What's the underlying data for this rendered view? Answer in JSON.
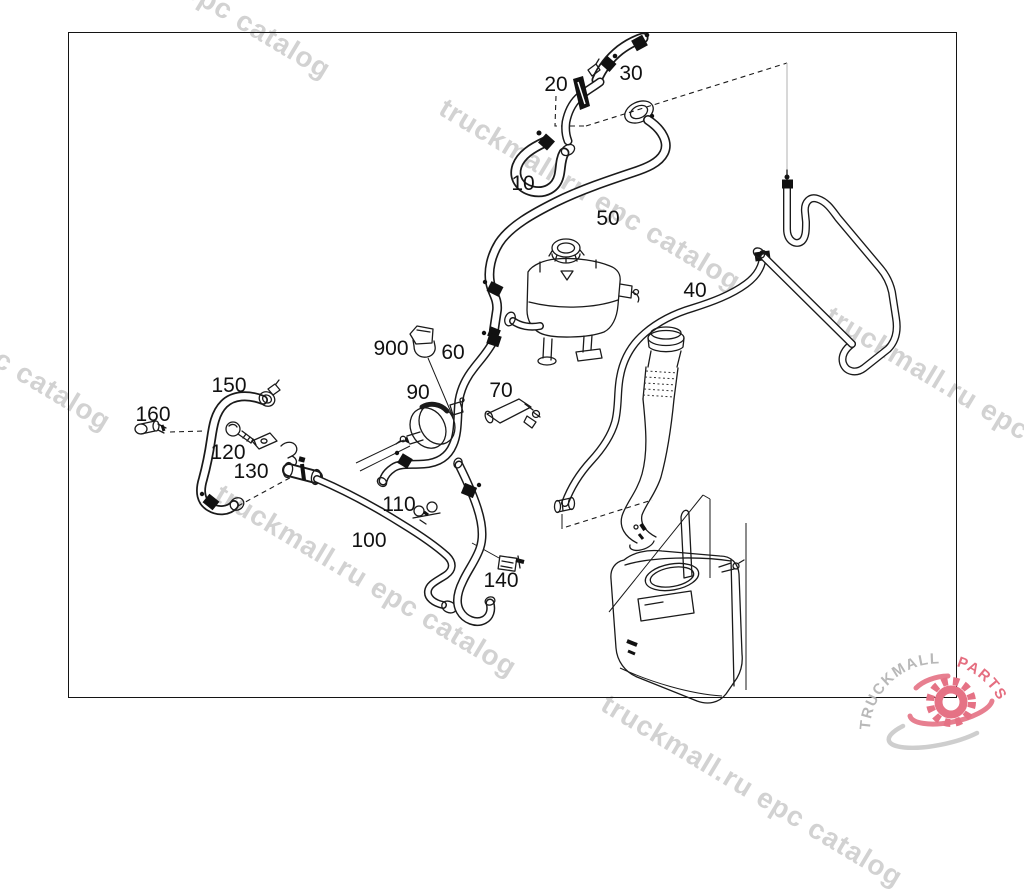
{
  "watermark": {
    "text": "truckmall.ru epc catalog"
  },
  "logo": {
    "brand": "TRUCKMALL",
    "suffix": "PARTS",
    "brand_color": "#b5b5b5",
    "suffix_color": "#e56e80",
    "gear_color": "#e57285",
    "swoosh_gray_color": "#c9c9c9"
  },
  "diagram": {
    "type": "exploded-parts-line-drawing",
    "subject": "hoses, clamps, expansion tank and reservoir",
    "part_callouts": [
      "10",
      "20",
      "30",
      "40",
      "50",
      "60",
      "70",
      "90",
      "100",
      "110",
      "120",
      "130",
      "140",
      "150",
      "160",
      "900"
    ]
  },
  "labels": {
    "n10": "10",
    "n20": "20",
    "n30": "30",
    "n40": "40",
    "n50": "50",
    "n60": "60",
    "n70": "70",
    "n90": "90",
    "n100": "100",
    "n110": "110",
    "n120": "120",
    "n130": "130",
    "n140": "140",
    "n150": "150",
    "n160": "160",
    "n900": "900"
  }
}
